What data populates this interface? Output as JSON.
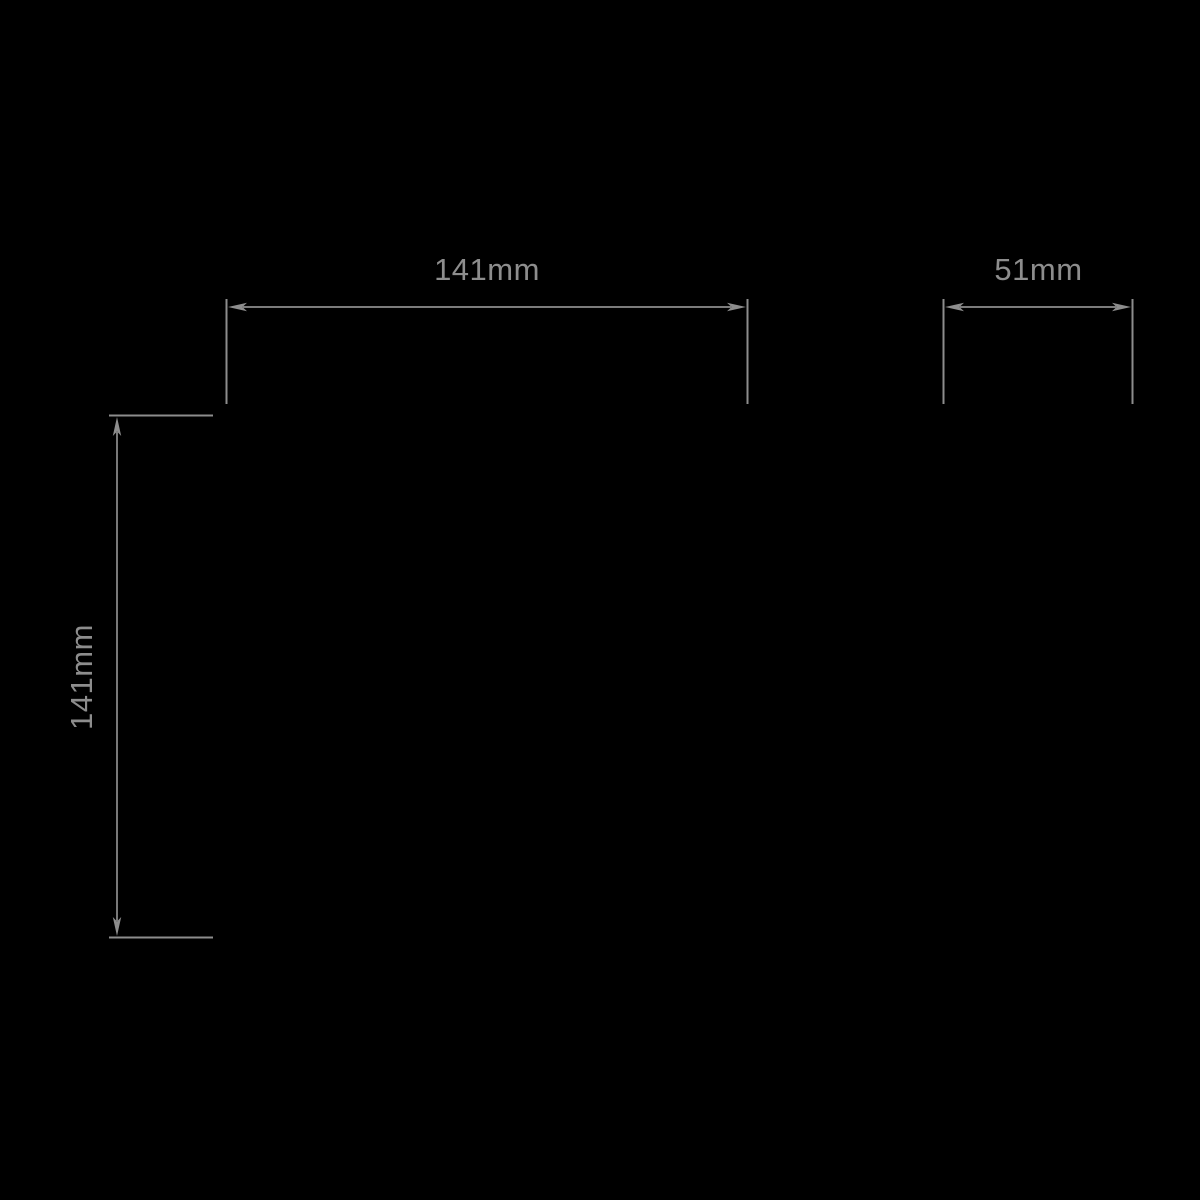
{
  "page": {
    "background_color": "#000000"
  },
  "diagram": {
    "type": "dimension-drawing",
    "line_color": "#8d8d8d",
    "text_color": "#8d8d8d",
    "dimensions": {
      "width": {
        "label": "141mm",
        "orientation": "horizontal"
      },
      "projection": {
        "label": "51mm",
        "orientation": "horizontal"
      },
      "height": {
        "label": "141mm",
        "orientation": "vertical"
      }
    }
  }
}
